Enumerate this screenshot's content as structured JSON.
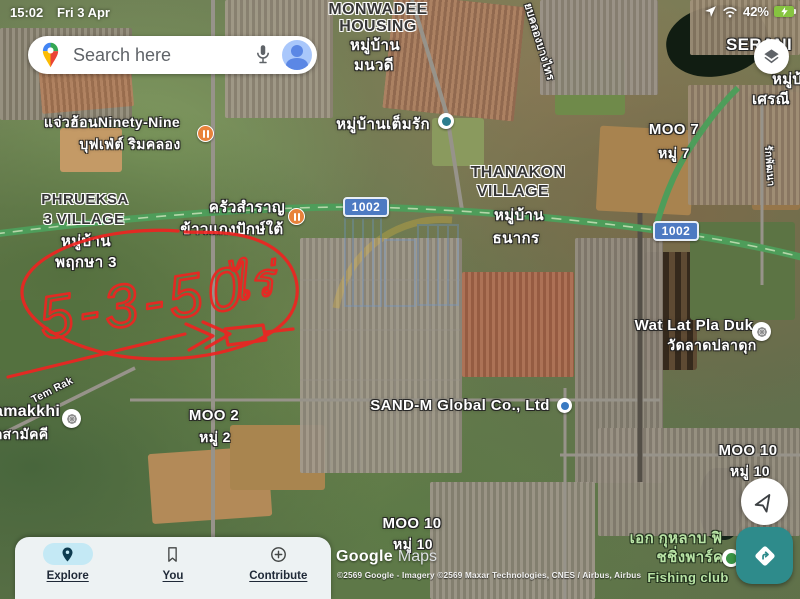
{
  "status_bar": {
    "time": "15:02",
    "date": "Fri 3 Apr",
    "battery": "42%"
  },
  "search": {
    "placeholder": "Search here"
  },
  "map": {
    "labels": {
      "monwadee": {
        "en1": "MONWADEE",
        "en2": "HOUSING",
        "th1": "หมู่บ้าน",
        "th2": "มนวดี"
      },
      "serani": {
        "en": "SERANI",
        "th1": "หมู่บ้าน",
        "th2": "เศรณี"
      },
      "ninety_nine": {
        "line1": "แจ่วฮ้อนNinety-Nine",
        "line2": "บุฟเฟ่ต์ ริมคลอง"
      },
      "temrak_village": {
        "th": "หมู่บ้านเต็มรัก"
      },
      "thanakon": {
        "en1": "THANAKON",
        "en2": "VILLAGE",
        "th1": "หมู่บ้าน",
        "th2": "ธนากร"
      },
      "phrueksa": {
        "en1": "PHRUEKSA",
        "en2": "3 VILLAGE",
        "th1": "หมู่บ้าน",
        "th2": "พฤกษา 3"
      },
      "krua_samran": {
        "line1": "ครัวสำราญ",
        "line2": "ข้าวแกงปักษ์ใต้"
      },
      "wat": {
        "en": "Wat Lat Pla Duk",
        "th": "วัดลาดปลาดุก"
      },
      "moo2": {
        "en": "MOO 2",
        "th": "หมู่ 2"
      },
      "moo7": {
        "en": "MOO 7",
        "th": "หมู่ 7"
      },
      "moo10_right": {
        "en": "MOO 10",
        "th": "หมู่ 10"
      },
      "moo10_bottom": {
        "en": "MOO 10",
        "th": "หมู่ 10"
      },
      "sandm": {
        "en": "SAND-M Global Co., Ltd"
      },
      "samakkhi": {
        "en": "amakkhi",
        "th": "รักสามัคคี"
      },
      "fishing": {
        "th1": "เอก กุหลาบ ฟิ",
        "th2": "ชชิ่งพาร์ค",
        "en": "Fishing club"
      }
    },
    "road_badges": {
      "badge1": "1002",
      "badge2": "1002"
    },
    "road_labels": {
      "tem_rak": "Tem Rak",
      "khlong": "ยบคลองบางไทร",
      "phatthana": "รักพัฒนา"
    },
    "annotation": {
      "area": "5-3-50",
      "unit": "ไร่"
    },
    "attribution": {
      "logo1": "Google",
      "logo2": "Maps",
      "line": "©2569 Google - Imagery ©2569 Maxar Technologies, CNES / Airbus, Airbus"
    }
  },
  "bottom_nav": {
    "explore": "Explore",
    "you": "You",
    "contribute": "Contribute"
  },
  "colors": {
    "fab_teal": "#2e8b8b",
    "badge_blue": "#4d7ac2",
    "annotation_red": "#ee2421",
    "explore_pill": "#c4e9f5",
    "battery_green": "#86c440"
  }
}
